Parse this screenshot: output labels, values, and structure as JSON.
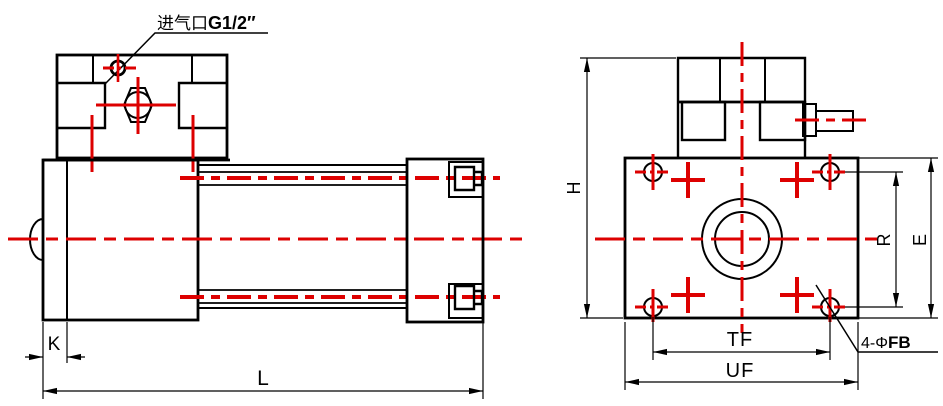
{
  "drawing": {
    "background": "#ffffff",
    "line_color": "#000000",
    "centerline_color": "#dd0000"
  },
  "labels": {
    "air_inlet": {
      "prefix": "进气口",
      "suffix": "G1/2″"
    },
    "dim_k": "K",
    "dim_l": "L",
    "dim_h": "H",
    "dim_r": "R",
    "dim_e": "E",
    "dim_tf": "TF",
    "dim_uf": "UF",
    "holes_callout": {
      "prefix": "4-Φ",
      "suffix": "FB"
    }
  }
}
